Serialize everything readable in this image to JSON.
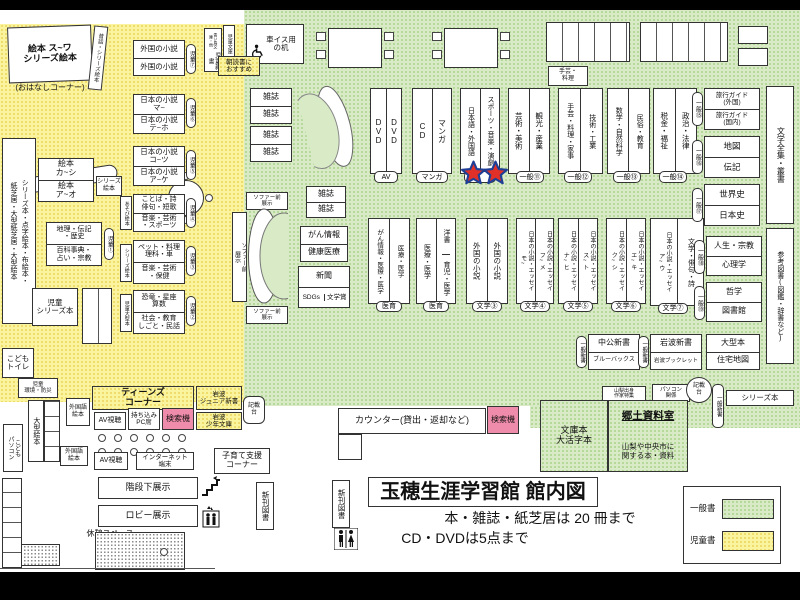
{
  "kids": {
    "ehon_corner": "絵本 ス~ワ\nシリーズ絵本",
    "ohanashi": "(おはなしコーナー)",
    "mukashi": "昔話・シリーズ絵本",
    "chishiki": "ちしきの絵本",
    "foreign_a": "外国の小説",
    "foreign_b": "外国の小説",
    "tag7": "児童⑦",
    "jp_ma": "日本の小説\nマ~",
    "jp_teho": "日本の小説\nテ~ホ",
    "tag6": "児童⑥",
    "jp_kotsu": "日本の小説\nコ~ツ",
    "jp_ake": "日本の小説\nア~ケ",
    "tag5": "児童⑤",
    "kotoba": "ことば・詩\n俳句・短歌",
    "geijutsu_sports": "音楽・芸術\n・スポーツ",
    "tag4": "児童④",
    "asobi": "あそび絵本",
    "pet": "ペット・料理\n理科・車",
    "geijutsu_hoken": "音楽・芸術\n・保健",
    "tag3": "児童③",
    "series_side1": "シリーズ絵本",
    "kyoryu": "恐竜・星座\n算数",
    "shakai": "社会・教育\nしごと・民話",
    "tag2": "児童②",
    "ogata_side": "児童大型本",
    "ehon_kashi": "絵本\nカ~シ",
    "ehon_ao": "絵本\nア~オ",
    "series_box": "シリーズ\n絵本",
    "chiri": "地理・伝記\n・歴史",
    "hyakka": "百科事典・\n占い・宗教",
    "tag1": "児童①",
    "left_tall": "シリーズ本・点字絵本・布絵本・\n紙芝居・大型紙芝居・大型絵本",
    "jido_series": "児童\nシリーズ本",
    "toilet": "こども\nトイレ",
    "kankyo": "児童\n環境・防災",
    "ogata_ehon": "大型絵本",
    "kodomo_pc": "こども\nパソコン",
    "gaikokugo1": "外国語\n絵本",
    "gaikokugo2": "外国語\n絵本",
    "teens": "ティーンズ\nコーナー",
    "av1": "AV視聴",
    "mochikomi": "持ち込み\nPC席",
    "kensaku1": "検索機",
    "iwanami_jr": "岩波\nジュニア新書",
    "iwanami_sho": "岩波\n少年文庫",
    "av2": "AV視聴",
    "internet": "インターネット\n端末",
    "kisaidai1": "記載\n台",
    "kosodate": "子育て支援\nコーナー",
    "kaidan": "階段下展示",
    "lobby": "ロビー展示",
    "kyukei": "休憩スペース",
    "shinkan1": "新刊図書",
    "shinkan2": "新刊図書"
  },
  "top": {
    "kurumaisu": "車イス用\nの机",
    "jido_shinsho": "児童新書",
    "aoitori": "青い鳥文庫・他",
    "jido_bunko": "児童文庫",
    "asadoku": "朝読書に\nおすすめ",
    "zasshi": "雑誌",
    "shugei": "手芸・\n料理"
  },
  "mid": {
    "sofa_v": "ソファー前\n展示",
    "sofa_h1": "ソファー前\n展示",
    "sofa_h2": "ソファー前\n展示",
    "gan": "がん情報",
    "kenko": "健康医療",
    "shimbun": "新聞",
    "sdgs": "SDGs",
    "bungakusho": "文学賞"
  },
  "row1": [
    {
      "c1": "DVD",
      "c2": "DVD",
      "tag": "AV"
    },
    {
      "c1": "CD",
      "c2": "マンガ",
      "tag": "マンガ"
    },
    {
      "c1": "日本語・外国語",
      "c2": "スポーツ・音楽・演劇",
      "tag": ""
    },
    {
      "c1": "芸術・美術",
      "c2": "観光・産業",
      "tag": "一般⑪"
    },
    {
      "c1": "手芸・料理・家事",
      "c2": "技術・工業",
      "tag": "一般⑫"
    },
    {
      "c1": "数学・自然科学",
      "c2": "民俗・教育",
      "tag": "一般⑬"
    },
    {
      "c1": "税金・福祉",
      "c2": "政治・法律",
      "tag": "一般⑭"
    }
  ],
  "row2": [
    {
      "c1": "がん情報・医療・医学",
      "c2": "医療・医学",
      "tag": "医育"
    },
    {
      "c1": "医療・医学",
      "c2a": "洋書",
      "c2b": "育児・医学",
      "tag": "医育"
    },
    {
      "c1": "外国の小説",
      "c2": "外国の小説",
      "tag": "文学③"
    },
    {
      "c1": "日本の小説・エッセイ\nモ~",
      "c2": "日本の小説・エッセイ\nフ~メ",
      "tag": "文学④"
    },
    {
      "c1": "日本の小説・エッセイ\nナ~ヒ",
      "c2": "日本の小説・エッセイ\nス~ト",
      "tag": "文学⑤"
    },
    {
      "c1": "日本の小説・エッセイ\nク~シ",
      "c2": "日本の小説・エッセイ\nエ~キ",
      "tag": "文学⑥"
    },
    {
      "c1": "日本の小説・エッセイ\nア~ウ",
      "c2": "文学・俳句・詩",
      "tag": "文学⑦"
    }
  ],
  "right": {
    "travel_gaikoku": "旅行ガイド\n(外国)",
    "travel_kokunai": "旅行ガイド\n(国内)",
    "tag15": "一般⑮",
    "chizu": "地図",
    "denki": "伝記",
    "tag16": "一般⑯",
    "sekaishi": "世界史",
    "nihonshi": "日本史",
    "tag17": "一般⑰",
    "jinsei": "人生・宗教",
    "shinri": "心理学",
    "tag18": "一般⑱",
    "tetsugaku": "哲学",
    "toshokan": "図書館",
    "tag19": "一般⑲",
    "zenshu": "文学全集・叢書",
    "sanko": "参考図書(図鑑・辞書など)"
  },
  "south": {
    "chuko": "中公新書",
    "bluebacks": "ブルーバックス",
    "tag_shinsho1": "一般新書",
    "iwanami": "岩波新書",
    "booklet": "岩波ブックレット",
    "tag_shinsho2": "一般新書",
    "ogata": "大型本",
    "jutaku": "住宅地図",
    "yamanashi": "山梨出身\n作家特集",
    "pc": "パソコン\n関係",
    "kisaidai2": "記載\n台",
    "tag_shinsho3": "一般新書",
    "series": "シリーズ本",
    "bunko": "文庫本\n大活字本",
    "kyodo_title": "郷土資料室",
    "kyodo_desc": "山梨や中央市に\n関する本・資料",
    "counter": "カウンター(貸出・返却など)",
    "kensaku2": "検索機"
  },
  "footer": {
    "title": "玉穂生涯学習館 館内図",
    "rule1": "本・雑誌・紙芝居は 20 冊まで",
    "rule2": "CD・DVDは5点まで",
    "legend_general": "一般書",
    "legend_children": "児童書"
  },
  "colors": {
    "children_yellow": "#fbf49e",
    "general_green": "#d9ebc6",
    "search_pink": "#f08cab",
    "star_red": "#e03028",
    "star_outline_blue": "#1f3f96"
  }
}
